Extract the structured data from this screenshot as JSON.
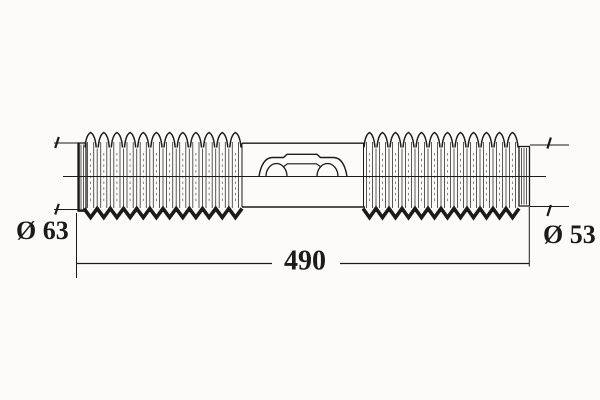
{
  "diagram": {
    "labels": {
      "left_diameter": "Ø 63",
      "right_diameter": "Ø 53",
      "length": "490"
    },
    "dimensions": {
      "left_diameter": 63,
      "right_diameter": 53,
      "length": 490
    },
    "colors": {
      "line": "#1b1b1b",
      "background": "#fcfbf9"
    },
    "geometry": {
      "left_bellows": {
        "x0": 84,
        "x1": 242,
        "pleats": 12
      },
      "right_bellows": {
        "x0": 363,
        "x1": 519,
        "pleats": 12
      },
      "peak_top_y": 132.5,
      "valley_y": 147.5,
      "fold_top_y": 142,
      "fold_bottom_y": 208,
      "zigzag_top_y": 208.5,
      "zigzag_bottom_y": 217.5
    }
  }
}
